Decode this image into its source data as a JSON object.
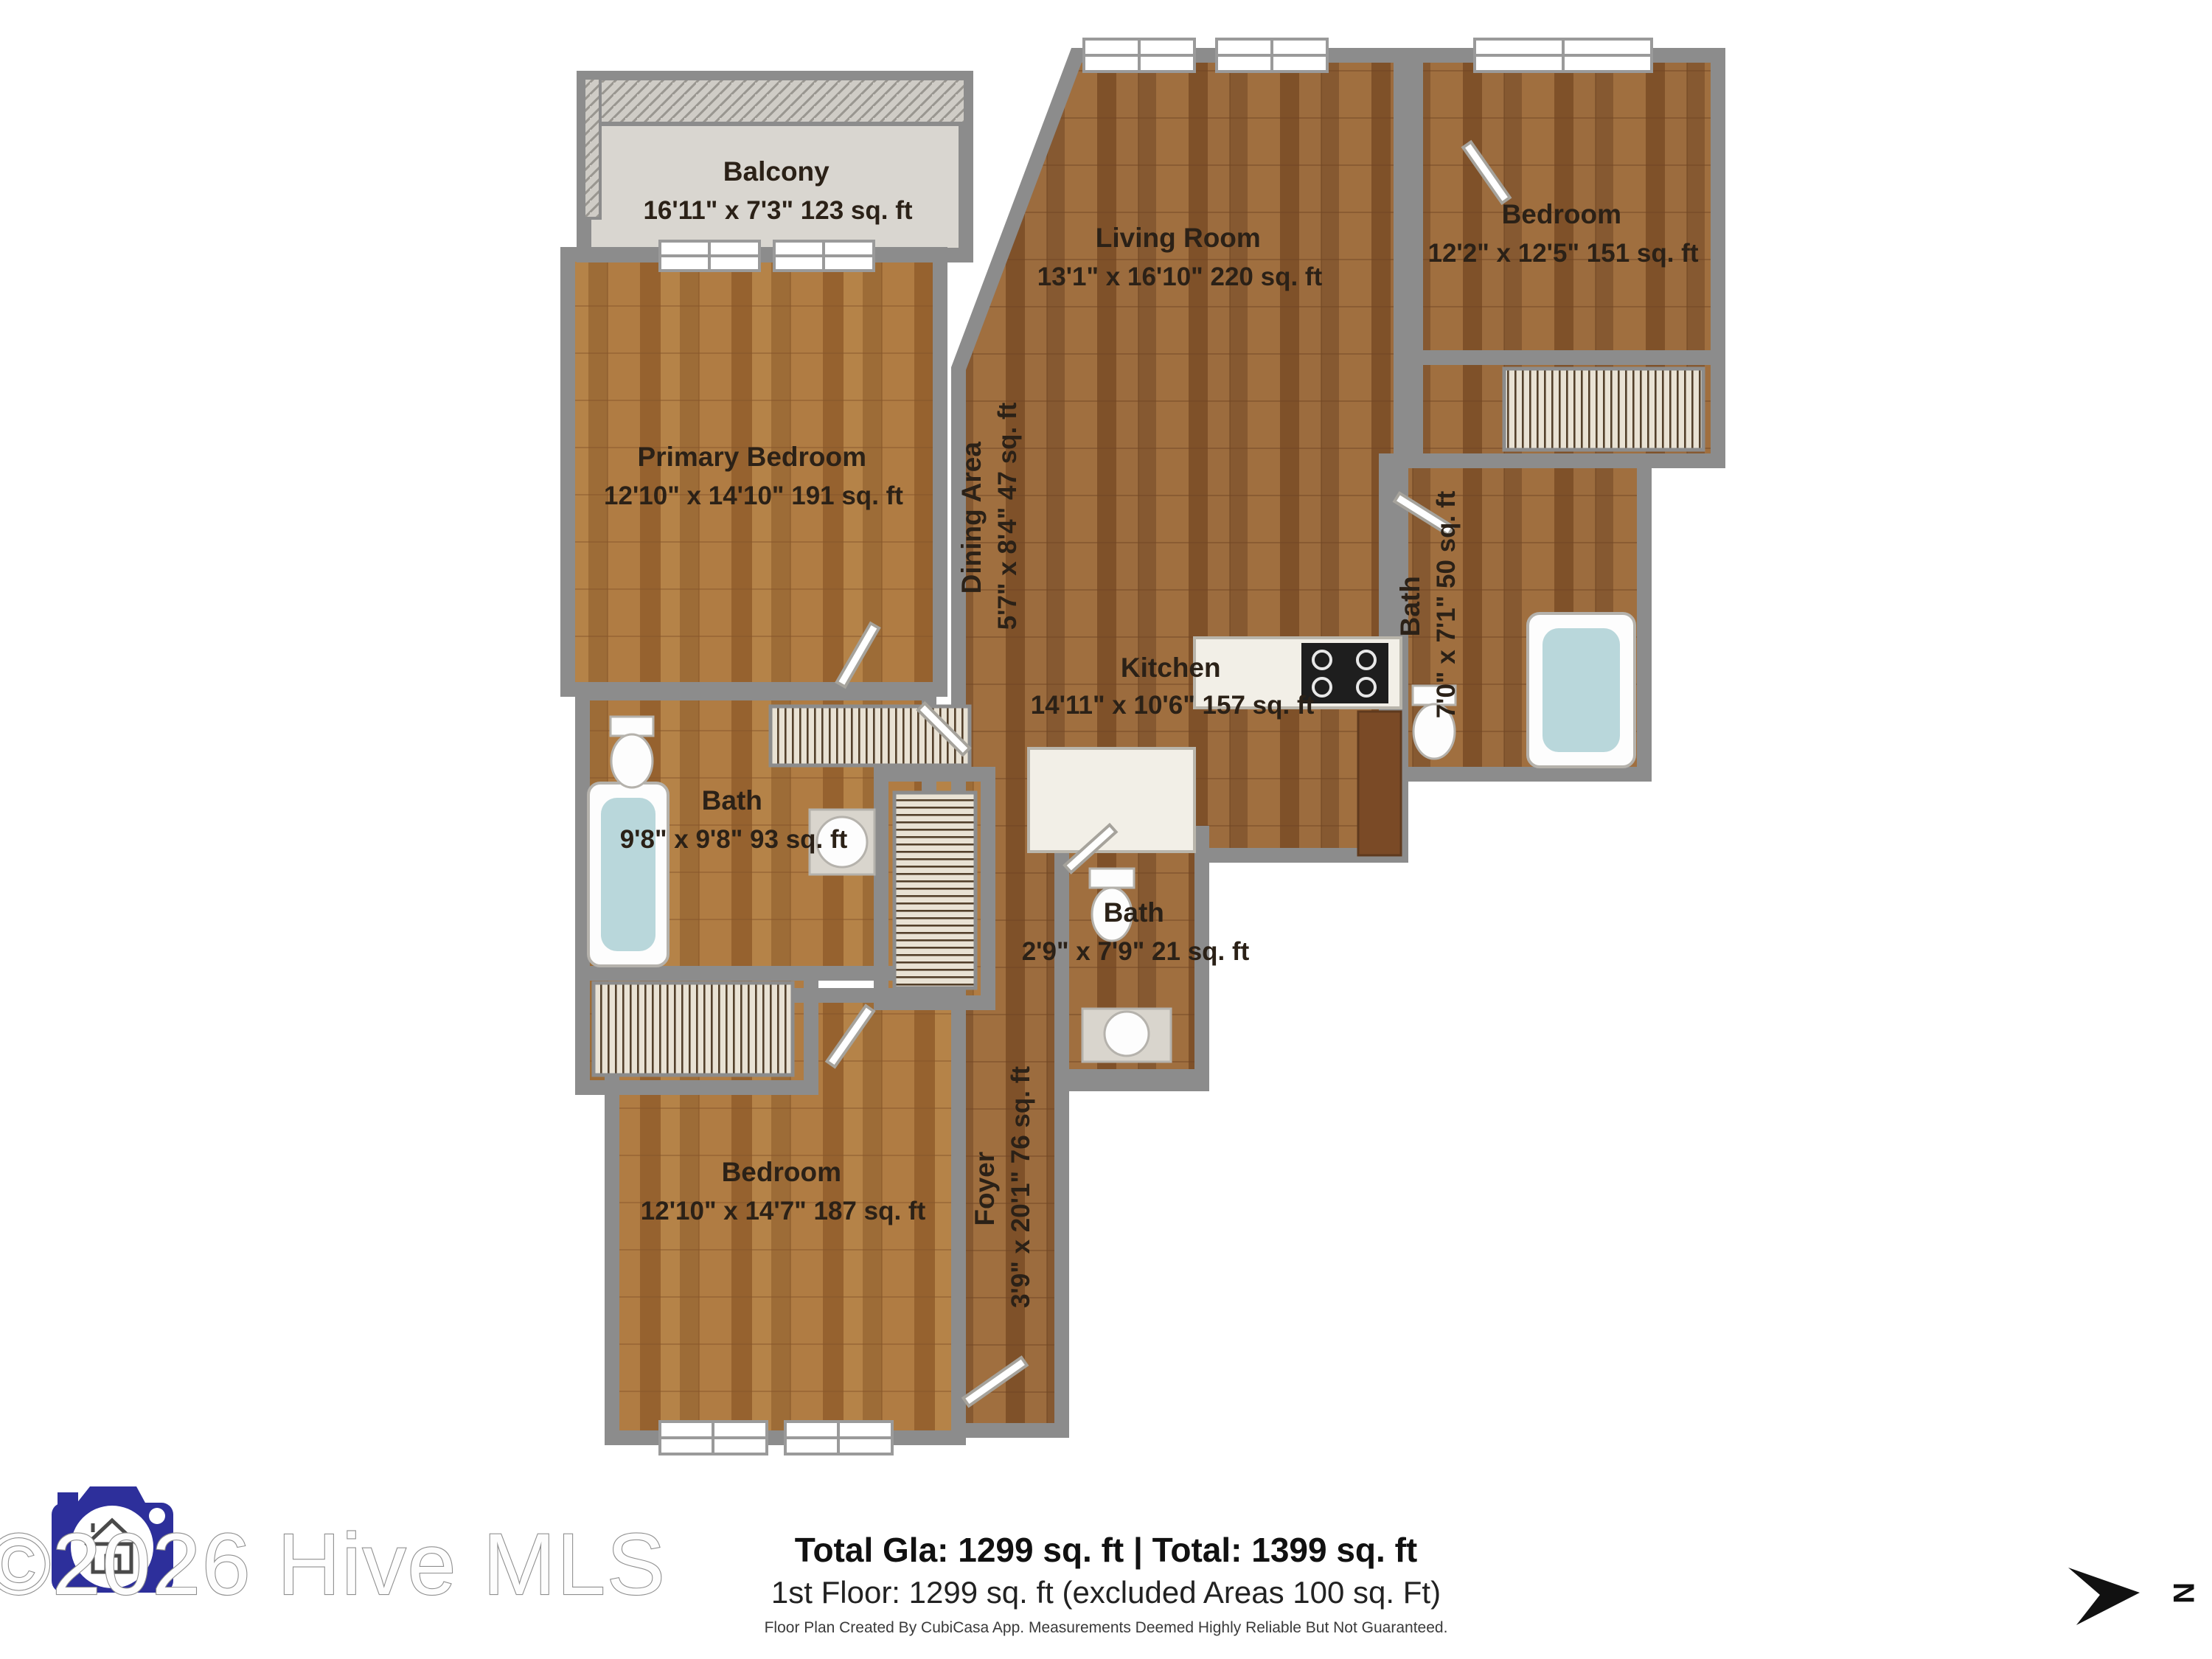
{
  "plan": {
    "rooms": {
      "balcony": {
        "name": "Balcony",
        "dims": "16'11\" x 7'3\" 123 sq. ft"
      },
      "living_room": {
        "name": "Living Room",
        "dims": "13'1\" x 16'10\" 220 sq. ft"
      },
      "bedroom_right": {
        "name": "Bedroom",
        "dims": "12'2\" x 12'5\" 151 sq. ft"
      },
      "primary_bedroom": {
        "name": "Primary Bedroom",
        "dims": "12'10\" x 14'10\" 191 sq. ft"
      },
      "dining_area": {
        "name": "Dining Area",
        "dims": "5'7\" x 8'4\" 47 sq. ft"
      },
      "kitchen": {
        "name": "Kitchen",
        "dims": "14'11\" x 10'6\" 157 sq. ft"
      },
      "bath_right": {
        "name": "Bath",
        "dims": "7'0\" x 7'1\" 50 sq. ft"
      },
      "bath_left": {
        "name": "Bath",
        "dims": "9'8\" x 9'8\" 93 sq. ft"
      },
      "bath_middle": {
        "name": "Bath",
        "dims": "2'9\" x 7'9\" 21 sq. ft"
      },
      "foyer": {
        "name": "Foyer",
        "dims": "3'9\" x 20'1\" 76 sq. ft"
      },
      "bedroom_bottom": {
        "name": "Bedroom",
        "dims": "12'10\" x 14'7\" 187 sq. ft"
      }
    },
    "compass_label": "N"
  },
  "footer": {
    "totals_bold": "Total Gla: 1299 sq. ft | Total: 1399 sq. ft",
    "totals_sub": "1st Floor: 1299 sq. ft (excluded Areas 100 sq. Ft)",
    "disclaimer": "Floor Plan Created By CubiCasa App. Measurements Deemed Highly Reliable But Not Guaranteed."
  },
  "watermark": {
    "text": "©2026 Hive MLS"
  },
  "colors": {
    "wall": "#8c8c8c",
    "wood_dark": "#8a5a33",
    "wood_light": "#a9743f",
    "balcony_floor": "#d9d6d0",
    "tub_water": "#b9d7db",
    "fixture_white": "#fdfdfd",
    "logo_blue": "#2d2f9b",
    "label_text": "#2b2117"
  }
}
